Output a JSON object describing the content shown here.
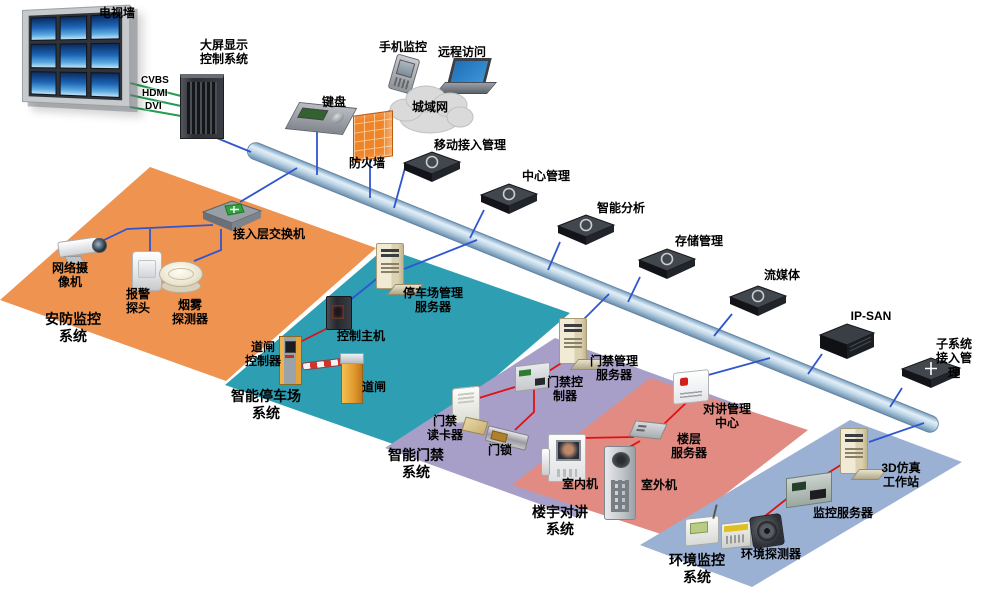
{
  "labels": {
    "tv_wall": "电视墙",
    "display_control": "大屏显示\n控制系统",
    "cvbs": "CVBS",
    "hdmi": "HDMI",
    "dvi": "DVI",
    "keyboard": "键盘",
    "phone_monitor": "手机监控",
    "remote_access": "远程访问",
    "metro_net": "城域网",
    "firewall": "防火墙",
    "mobile_access": "移动接入管理",
    "center_mgmt": "中心管理",
    "intel_analysis": "智能分析",
    "storage_mgmt": "存储管理",
    "stream_media": "流媒体",
    "ip_san": "IP-SAN",
    "subsys_access": "子系统接入管理",
    "access_switch": "接入层交换机",
    "net_camera": "网络摄\n像机",
    "alarm_probe": "报警\n探头",
    "smoke_detector": "烟雾\n探测器",
    "parking_server": "停车场管理\n服务器",
    "control_host": "控制主机",
    "barrier_ctrl": "道闸\n控制器",
    "barrier": "道闸",
    "door_server": "门禁管理\n服务器",
    "door_ctrl": "门禁控\n制器",
    "card_reader": "门禁\n读卡器",
    "door_lock": "门锁",
    "intercom_center": "对讲管理\n中心",
    "floor_server": "楼层\n服务器",
    "indoor_unit": "室内机",
    "outdoor_unit": "室外机",
    "sim3d": "3D仿真\n工作站",
    "monitor_server": "监控服务器",
    "env_detector": "环境探测器"
  },
  "zones": [
    {
      "id": "security-monitoring",
      "label": "安防监控\n系统",
      "color": "#EF9351"
    },
    {
      "id": "smart-parking",
      "label": "智能停车场\n系统",
      "color": "#2E9FB3"
    },
    {
      "id": "smart-access",
      "label": "智能门禁\n系统",
      "color": "#A89FC8"
    },
    {
      "id": "building-intercom",
      "label": "楼宇对讲\n系统",
      "color": "#E18B82"
    },
    {
      "id": "environment-monitoring",
      "label": "环境监控\n系统",
      "color": "#9BB1D4"
    }
  ],
  "colors": {
    "line_blue": "#2F55CF",
    "line_red": "#E01111",
    "line_green": "#1F9E4F",
    "zone_orange": "#EF9351",
    "zone_teal": "#2E9FB3",
    "zone_purple": "#A89FC8",
    "zone_salmon": "#E18B82",
    "zone_blue": "#9BB1D4",
    "pipe_light": "#E2EFF8",
    "pipe_dark": "#6E8FAE"
  }
}
